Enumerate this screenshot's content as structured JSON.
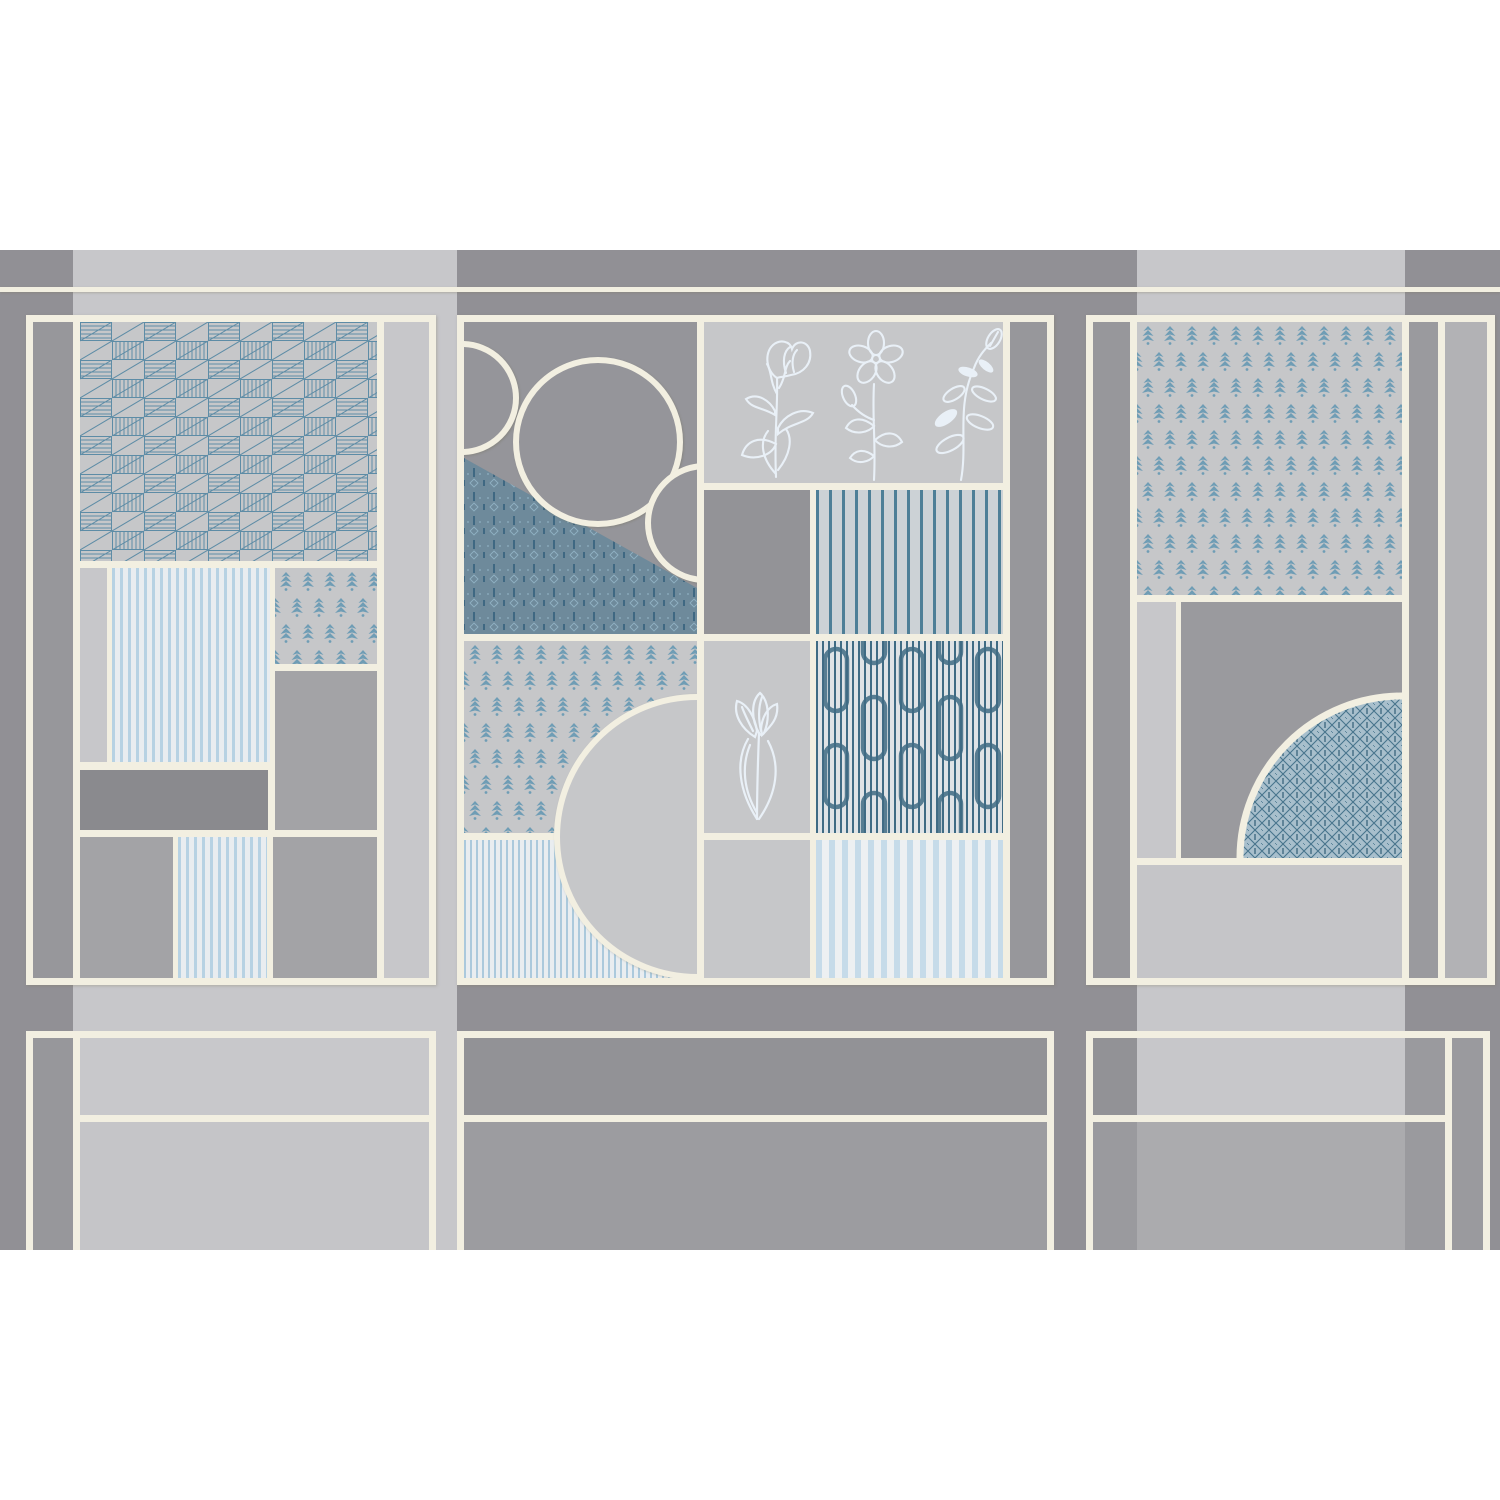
{
  "artwork": {
    "kind": "art-deco-wall-panel-mural",
    "sections": {
      "left-panel": "checkerboard hatch tile, pinstripe tiles, petit floral tile, plain gray tiles",
      "center-panel": "circle composition over damask, botanical line-art tiles, stripe tiles, circuit pattern tile, large half disc",
      "right-panel": "large petit floral tile, gray tile with quarter disc of lattice pattern, plain light tile",
      "bottom-row": "three plain framed wainscot panels cropped at bottom edge"
    },
    "patterns": {
      "checker-hatch-pattern": "checkerboard of blue diagonal-hatched squares",
      "petit-floral-pattern": "small blue budding-leaf motif in offset rows",
      "damask-pattern": "dense teal damask with dashes and diamonds",
      "circuit-pattern": "fine vertical pinstripes with chain-link elbows",
      "lattice-pattern": "blue diamond lattice with dark ticks",
      "pinstripe-pattern": "thin pale blue vertical stripes",
      "wide-stripe-pattern": "wide pale blue vertical stripes",
      "teal-stripe-pattern": "spaced dark teal vertical stripes",
      "botanical-lineart": "three white hand-drawn flower stems",
      "crocus-lineart": "white hand-drawn crocus flower"
    }
  },
  "palette": {
    "white": "#ffffff",
    "wall_dark": "#919095",
    "wall_light": "#c7c7ca",
    "cream": "#f2efe1",
    "tile_light": "#c6c7c9",
    "tile_mid": "#a3a3a6",
    "tile_dark": "#97979b",
    "tile_darker": "#8a8a8e",
    "center_dark_tile": "#939397",
    "circles_bg": "#95959a",
    "right_dark_tile": "#9a9a9e",
    "col_med": "#b2b2b5",
    "bottom_med": "#ababae",
    "bottom_light_top": "#c8c8cb",
    "bottom_light_below": "#c5c5c8",
    "bottom_dark_top": "#929296",
    "bottom_dark_below": "#9c9ca0",
    "blue_stripe_thin": "#abc9dc",
    "stripe_bg": "#e9edf0",
    "stripe_pale": "#b7d2e3",
    "stripe_wide": "#c6dbe9",
    "stripe_wide_bg": "#edf0f2",
    "teal_stripe": "#4e7f97",
    "teal_stripe_bg": "#ccd2d6",
    "hatch_blue": "#5d8ca6",
    "motif_blue": "#6f9db5",
    "damask_bg": "#6e8a9b",
    "damask_dark": "#335f7c",
    "damask_light": "#8fb0c2",
    "lattice_bg": "#a8bfcc",
    "lattice_line": "#47748c",
    "lattice_dark": "#2f5d76",
    "circuit_line": "#3f6b84",
    "circuit_bg": "#dfe3e6",
    "lineart": "#e9f0f7"
  }
}
